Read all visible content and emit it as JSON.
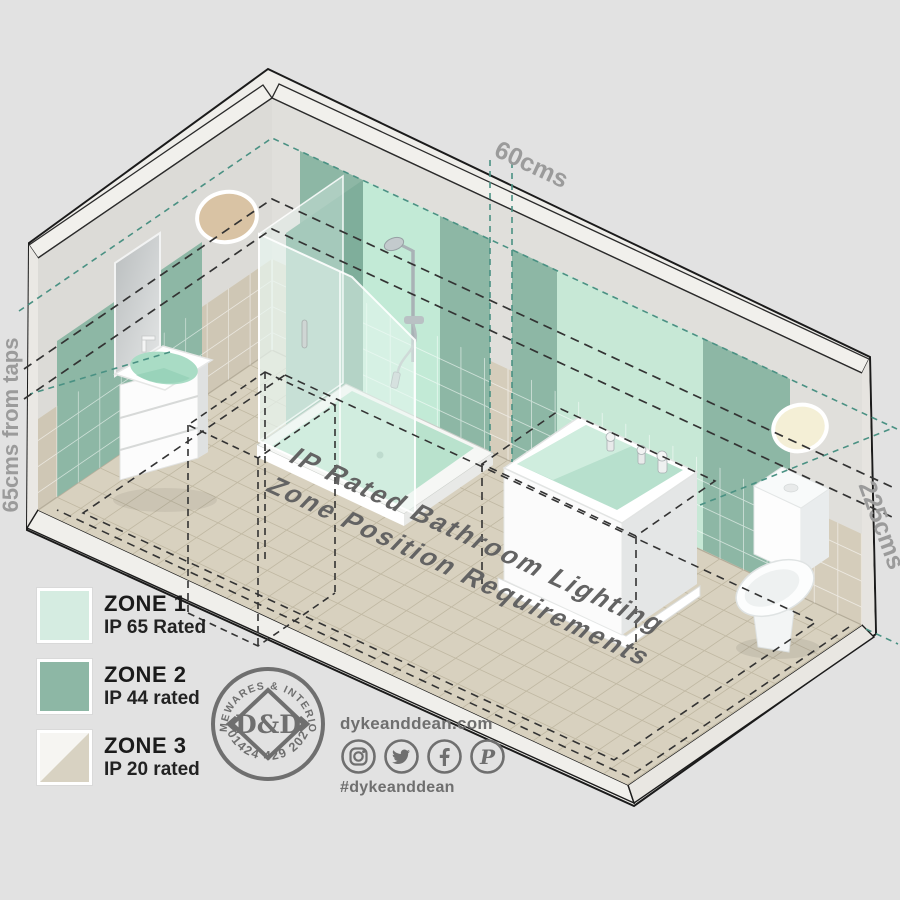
{
  "dimensions": {
    "top": "60cms",
    "left": "65cms from taps",
    "right": "225cms"
  },
  "floor_title": {
    "line1": "IP Rated Bathroom Lighting",
    "line2": "Zone Position Requirements"
  },
  "legend": {
    "items": [
      {
        "zone": "ZONE 1",
        "rating": "IP 65 Rated"
      },
      {
        "zone": "ZONE 2",
        "rating": "IP 44 rated"
      },
      {
        "zone": "ZONE 3",
        "rating": "IP 20 rated"
      }
    ]
  },
  "brand": {
    "stamp_top": "HOMEWARES & INTERIORS",
    "stamp_phone": "01424 429 202",
    "stamp_monogram": "D&D",
    "website": "dykeanddean.com",
    "hashtag": "#dykeanddean",
    "social_icons": [
      "instagram-icon",
      "twitter-icon",
      "facebook-icon",
      "pinterest-icon"
    ]
  },
  "colors": {
    "background": "#e2e2e2",
    "zone1": "#c7e8d6",
    "zone1_bright": "#c2ead6",
    "zone1_legend": "#d5ece1",
    "zone2": "#8db7a5",
    "zone2_dark": "#7fae9b",
    "zone3_light": "#f6f5f2",
    "zone3_beige": "#d8d2c2",
    "floor": "#d8d1bf",
    "wall_concrete": "#deddda",
    "wall_tile": "#d5cdbb",
    "slab": "#efeeea",
    "teal_dash": "#4a9183",
    "dark_dash": "#333333",
    "dim_text": "#9b9b9b",
    "floor_text": "#636363",
    "brand_gray": "#6f6f6f",
    "light_tan": "#d9c3a4",
    "light_cream": "#f4efd6"
  }
}
